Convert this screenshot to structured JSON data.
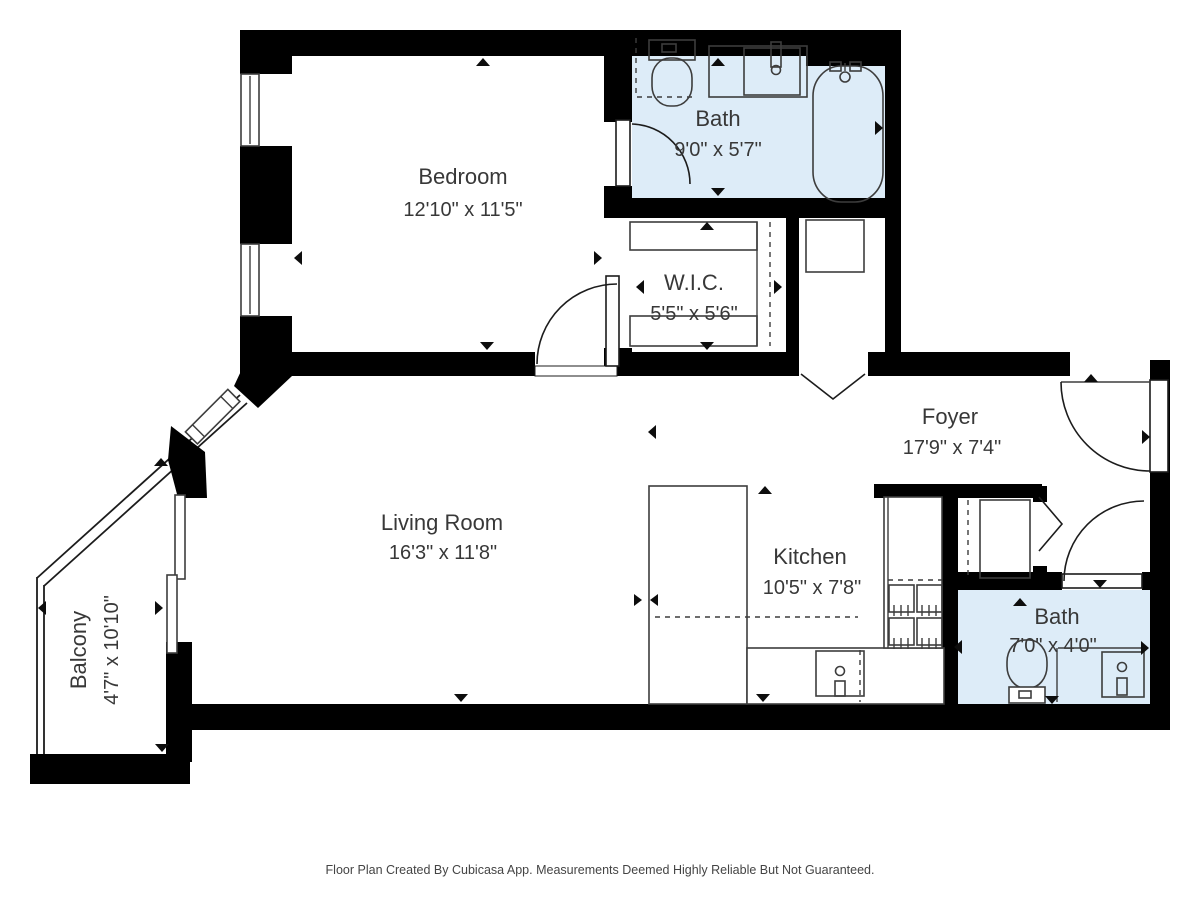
{
  "plan": {
    "rooms": [
      {
        "name": "Bedroom",
        "dims": "12'10\" x 11'5\""
      },
      {
        "name": "Bath",
        "dims": "9'0\" x 5'7\""
      },
      {
        "name": "W.I.C.",
        "dims": "5'5\" x 5'6\""
      },
      {
        "name": "Foyer",
        "dims": "17'9\" x 7'4\""
      },
      {
        "name": "Living Room",
        "dims": "16'3\" x 11'8\""
      },
      {
        "name": "Kitchen",
        "dims": "10'5\" x 7'8\""
      },
      {
        "name": "Bath",
        "dims": "7'0\" x 4'0\""
      },
      {
        "name": "Balcony",
        "dims": "4'7\" x 10'10\""
      }
    ],
    "footer": "Floor Plan Created By Cubicasa App. Measurements Deemed Highly Reliable But Not Guaranteed."
  },
  "colors": {
    "wall": "#000000",
    "bath_fill": "#ddecf8",
    "line": "#3d3d3d",
    "label": "#383838",
    "footer": "#444444",
    "bg": "#ffffff"
  }
}
